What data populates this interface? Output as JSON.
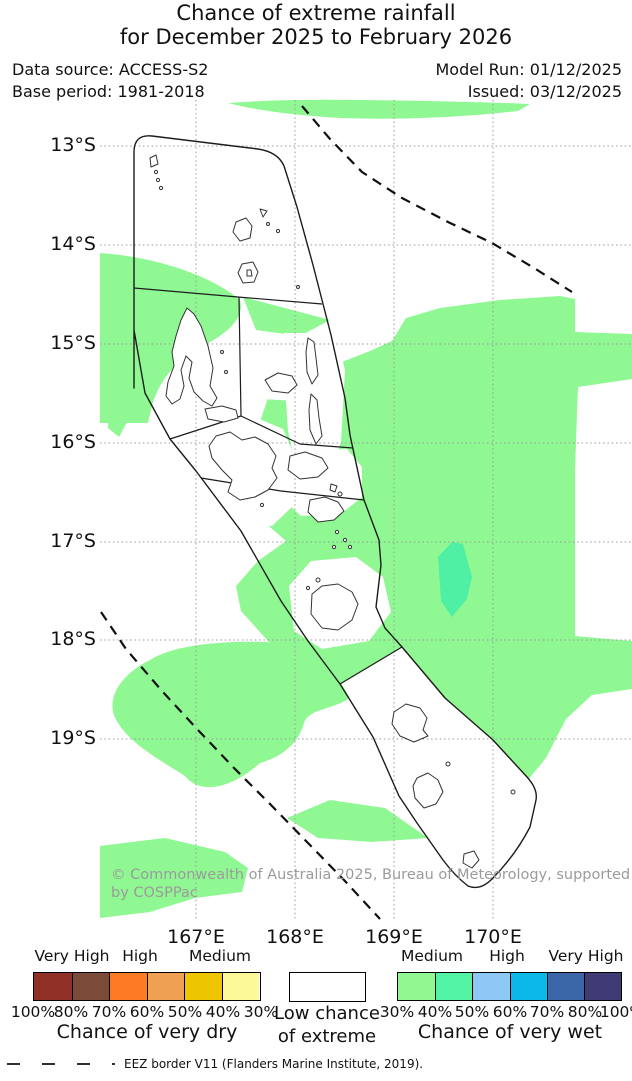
{
  "title_line1": "Chance of extreme rainfall",
  "title_line2": "for December 2025 to February 2026",
  "header": {
    "data_source": "Data source: ACCESS-S2",
    "base_period": "Base period: 1981-2018",
    "model_run": "Model Run: 01/12/2025",
    "issued": "Issued: 03/12/2025"
  },
  "map": {
    "y_ticks": [
      "13°S",
      "14°S",
      "15°S",
      "16°S",
      "17°S",
      "18°S",
      "19°S"
    ],
    "x_ticks": [
      "167°E",
      "168°E",
      "169°E",
      "170°E"
    ],
    "watermark": {
      "line1": "© Commonwealth of Australia 2025, Bureau of Meteorology, supported",
      "line2": "by COSPPac"
    },
    "shading_semantics": {
      "white": "Low chance of extreme",
      "pale_green": "30-40% chance of very wet",
      "teal_green": "40-50% chance of very wet"
    }
  },
  "colors": {
    "map-green": "#90f892",
    "map-teal": "#4fefa4",
    "gridline": "#999999",
    "boundary": "#1c1c1c",
    "island": "#333333",
    "watermark": "#9b9b9b"
  },
  "legend": {
    "dry": {
      "headers": [
        "Very High",
        "High",
        "Medium"
      ],
      "colors": [
        "#913027",
        "#7c4a38",
        "#fc7b24",
        "#efa053",
        "#edc500",
        "#fbf998"
      ],
      "ticks": [
        "100%",
        "80%",
        "70%",
        "60%",
        "50%",
        "40%",
        "30%"
      ],
      "caption": "Chance of very dry"
    },
    "none": {
      "caption_line1": "Low chance",
      "caption_line2": "of extreme"
    },
    "wet": {
      "headers": [
        "Medium",
        "High",
        "Very High"
      ],
      "colors": [
        "#91f891",
        "#52f3a5",
        "#8ec9f5",
        "#0cb8ea",
        "#3a66a8",
        "#3e3b75"
      ],
      "ticks": [
        "30%",
        "40%",
        "50%",
        "60%",
        "70%",
        "80%",
        "100%"
      ],
      "caption": "Chance of very wet"
    }
  },
  "footer": {
    "eez_note": "EEZ border V11 (Flanders Marine Institute, 2019)."
  }
}
